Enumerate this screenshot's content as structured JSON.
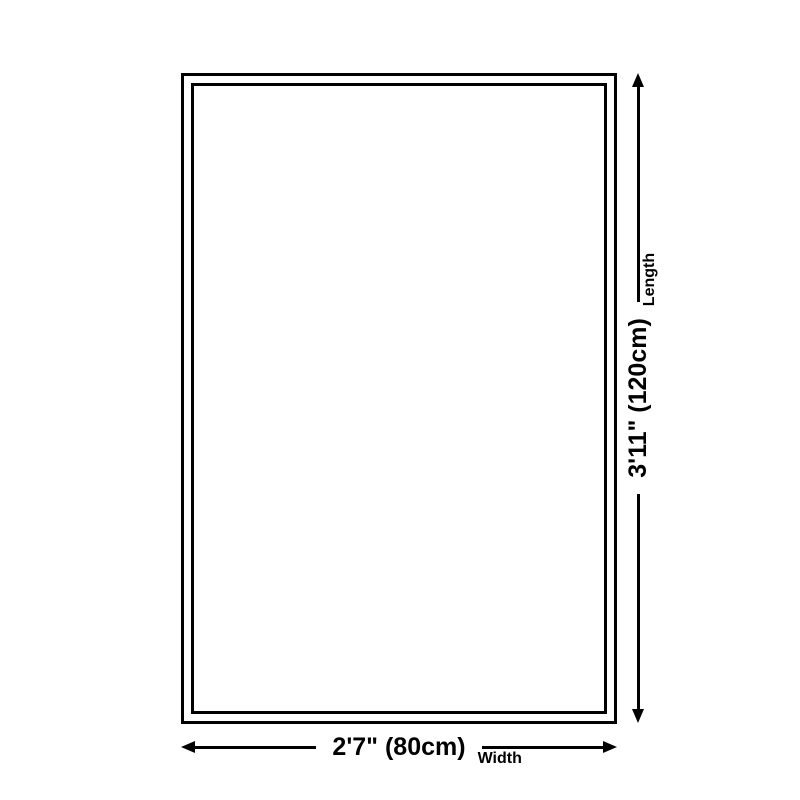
{
  "diagram": {
    "type": "product-size-diagram",
    "background_color": "#ffffff",
    "line_color": "#000000",
    "shape": "rectangle-double-border",
    "dimensions": {
      "width": {
        "value": "2'7\" (80cm)",
        "label": "Width"
      },
      "length": {
        "value": "3'11\" (120cm)",
        "label": "Length"
      }
    }
  }
}
